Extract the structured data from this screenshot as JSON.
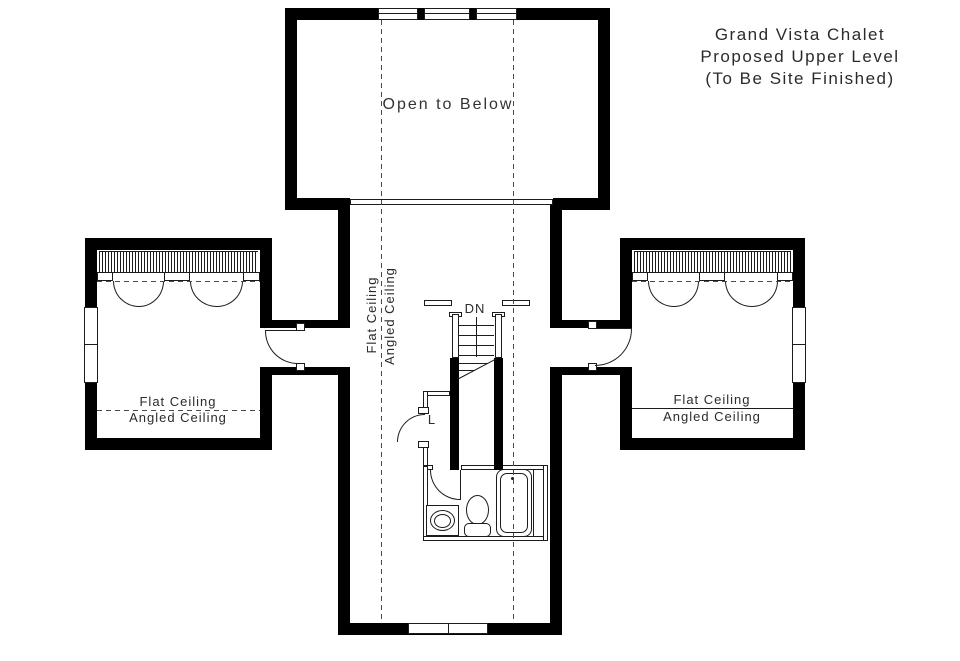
{
  "title_block": {
    "line1": "Grand Vista Chalet",
    "line2": "Proposed Upper Level",
    "line3": "(To Be Site Finished)"
  },
  "labels": {
    "open_to_below": "Open to Below",
    "stair_direction": "DN",
    "linen_closet": "L",
    "left_room_flat": "Flat Ceiling",
    "left_room_angled": "Angled Ceiling",
    "right_room_flat": "Flat Ceiling",
    "right_room_angled": "Angled Ceiling",
    "hall_flat": "Flat Ceiling",
    "hall_angled": "Angled Ceiling"
  },
  "fixtures": [
    "bathtub",
    "toilet",
    "sink-vanity"
  ],
  "colors": {
    "wall": "#000000",
    "line": "#1c1c1c",
    "dashed_line": "#4a4a4a",
    "text": "#2b2b2b",
    "background": "#ffffff"
  }
}
